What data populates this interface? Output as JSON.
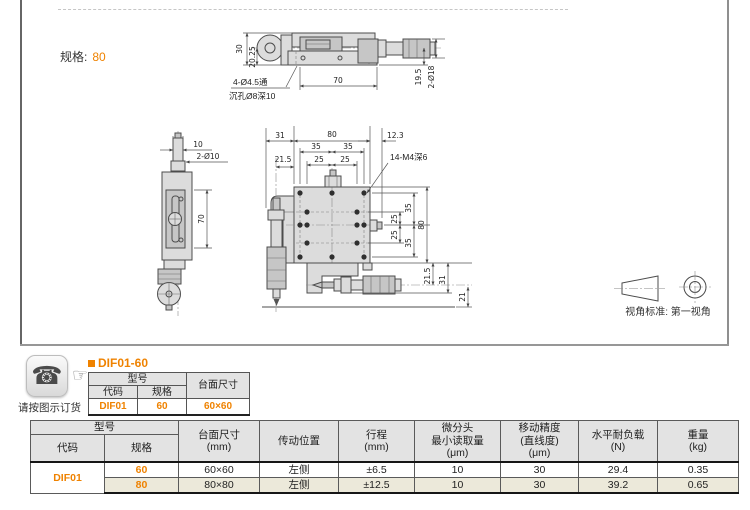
{
  "page": {
    "spec_label": "规格:",
    "spec_value": "80",
    "view_standard_caption": "视角标准: 第一视角",
    "order_note": "请按图示订货",
    "phone_icon_glyph": "☎",
    "finger_icon_glyph": "☞"
  },
  "colors": {
    "accent": "#ef8200",
    "header_bg": "#e3e3e3",
    "alt_row_bg": "#ece9da"
  },
  "drawing": {
    "side_top": {
      "d30": "30",
      "d2025": "20.25",
      "note1": "4-Ø4.5通",
      "note2": "沉孔Ø8深10",
      "d70": "70",
      "d195": "19.5",
      "d218": "2-Ø18"
    },
    "side_left": {
      "d10": "10",
      "d2010": "2-Ø10",
      "d70": "70"
    },
    "plan": {
      "d31": "31",
      "d80": "80",
      "d123": "12.3",
      "d35": "35",
      "d25": "25",
      "d215": "21.5",
      "note": "14-M4深6",
      "r25": "25",
      "r35": "35",
      "r80": "80",
      "b215": "21.5",
      "b31": "31",
      "b21": "21"
    }
  },
  "mini_table": {
    "title": "DIF01-60",
    "h_model": "型号",
    "h_code": "代码",
    "h_spec": "规格",
    "h_size": "台面尺寸",
    "code": "DIF01",
    "spec": "60",
    "size": "60×60"
  },
  "main_table": {
    "h_model": "型号",
    "h_code": "代码",
    "h_spec": "规格",
    "h_size_1": "台面尺寸",
    "h_size_2": "(mm)",
    "h_pos": "传动位置",
    "h_stroke_1": "行程",
    "h_stroke_2": "(mm)",
    "h_read_1": "微分头",
    "h_read_2": "最小读取量",
    "h_read_3": "(μm)",
    "h_acc_1": "移动精度",
    "h_acc_2": "(直线度)",
    "h_acc_3": "(μm)",
    "h_load_1": "水平耐负载",
    "h_load_2": "(N)",
    "h_weight_1": "重量",
    "h_weight_2": "(kg)",
    "code": "DIF01",
    "rows": [
      {
        "spec": "60",
        "size": "60×60",
        "pos": "左侧",
        "stroke": "±6.5",
        "read": "10",
        "acc": "30",
        "load": "29.4",
        "weight": "0.35"
      },
      {
        "spec": "80",
        "size": "80×80",
        "pos": "左侧",
        "stroke": "±12.5",
        "read": "10",
        "acc": "30",
        "load": "39.2",
        "weight": "0.65"
      }
    ]
  }
}
